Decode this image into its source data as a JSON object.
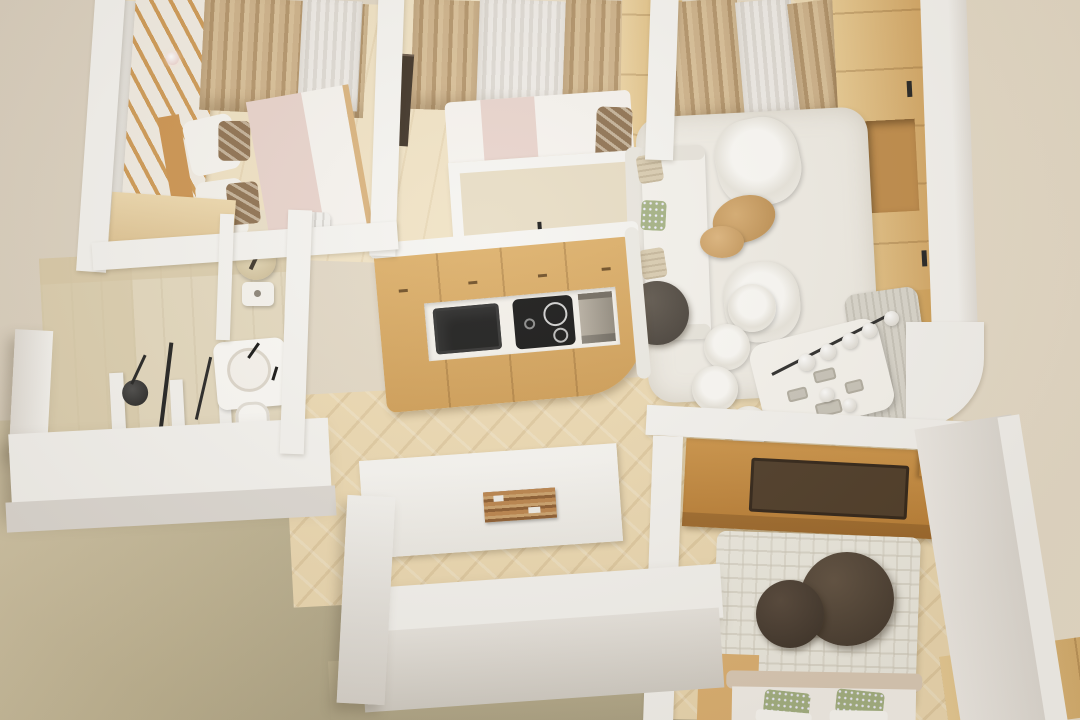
{
  "scene": {
    "title": "3D top-down render of an apartment floor plan",
    "view": "bird's-eye axonometric cutaway",
    "style": "photorealistic render, white walls, light oak floors"
  },
  "palette": {
    "bgLeft": "#dbd1c1",
    "bgRight": "#e9dfcd",
    "ground": "#bfb494",
    "groundLight": "#d7cbae",
    "groundDark": "#a9a083",
    "wall": "#f5f4f1",
    "wallFace": "#ddd9d4",
    "floorWood": "#ecd9b2",
    "floorPale": "#f0e2c4",
    "tile": "#e4d9bf",
    "tileShade": "#d8cba9",
    "woodMid": "#d6a159",
    "woodDark": "#c08441",
    "woodDeep": "#4c3a27",
    "curtain": "#c6aa82",
    "sheerFabric": "#e9e6e1",
    "rug": "#f0ede6",
    "sofa": "#f4f2ed",
    "blanket": "#e8d3cc",
    "duvet": "#f6f3ef",
    "poufGrey": "#48423d",
    "poufBrown": "#4e4236",
    "applianceBlack": "#1b1b1b",
    "steel": "#a79f92",
    "bench": "#dad7ce",
    "pillowGreen": "#a3b183",
    "pillowTan": "#d8cbb0"
  },
  "rooms": [
    {
      "id": "bedroom-1",
      "label": "Bedroom 1 — double bed, wardrobe, dresser, curtained window"
    },
    {
      "id": "bedroom-2",
      "label": "Bedroom 2 — double bed, wardrobe, picture frame, curtained window"
    },
    {
      "id": "living-room",
      "label": "Living room — sofa, two armchairs, coffee tables, rug, media wall"
    },
    {
      "id": "dining-area",
      "label": "Dining area — table, four chairs, bench, globe chandelier"
    },
    {
      "id": "kitchen",
      "label": "Kitchen — oak cabinets, sink, cooktop, oven"
    },
    {
      "id": "bathroom",
      "label": "Bathroom — walk-in shower, basin, toilet"
    },
    {
      "id": "wc",
      "label": "Guest WC — toilet"
    },
    {
      "id": "hallway",
      "label": "Hallway — herringbone parquet, wooden wall art"
    },
    {
      "id": "bedroom-3",
      "label": "Bedroom 3 — desk console, step shelves, rug with poufs, bed"
    },
    {
      "id": "exterior",
      "label": "Exterior ground plane"
    }
  ],
  "furniture": {
    "bedroom1": [
      "mirror-wardrobe",
      "slatted-wood-wardrobe",
      "double-bed",
      "pillows",
      "patterned-cushions",
      "pink-throw",
      "dresser",
      "ceiling-light"
    ],
    "bedroom2": [
      "curtains",
      "sheer-curtain",
      "wardrobe",
      "picture-frame",
      "double-bed",
      "dark-pillow",
      "tall-kitchen-unit",
      "radiator"
    ],
    "living": [
      "curtains",
      "media-wall-with-niche",
      "area-rug",
      "sofa",
      "throw-pillows",
      "dark-pouf",
      "armchair",
      "armchair",
      "nesting-coffee-tables"
    ],
    "dining": [
      "upholstered-bench",
      "dining-table",
      "place-settings",
      "four-tub-chairs",
      "globe-chandelier"
    ],
    "kitchen": [
      "oak-cabinet-run",
      "white-countertop",
      "black-sink",
      "induction-cooktop",
      "steel-oven",
      "cabinet-handles"
    ],
    "bathroom": [
      "rain-shower-head",
      "shower-rail",
      "glass-partitions",
      "round-basin",
      "black-faucets",
      "toilet"
    ],
    "bedroom3": [
      "wood-console-desk",
      "dark-inlay-tray",
      "step-shelves",
      "maze-pattern-rug",
      "two-dark-poufs",
      "bed-with-green-pillows",
      "low-cabinet"
    ]
  }
}
